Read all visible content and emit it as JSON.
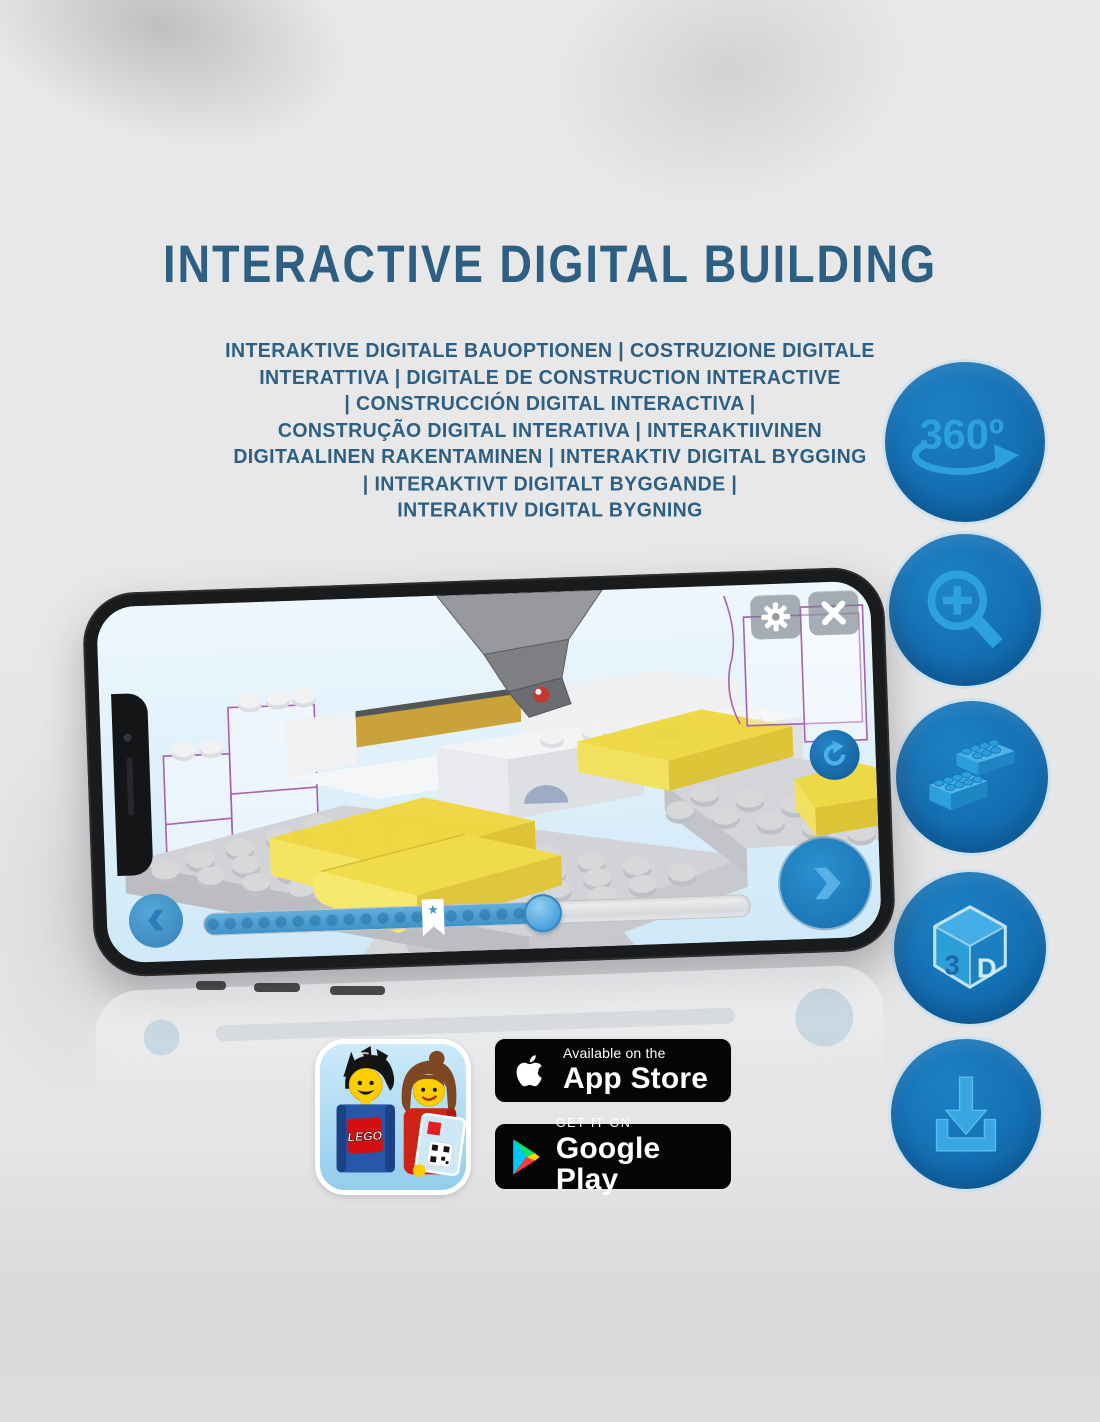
{
  "header": {
    "title": "INTERACTIVE DIGITAL BUILDING"
  },
  "subtitle": {
    "lines": [
      "INTERAKTIVE DIGITALE BAUOPTIONEN | COSTRUZIONE DIGITALE",
      "INTERATTIVA | DIGITALE DE CONSTRUCTION INTERACTIVE",
      "| CONSTRUCCIÓN DIGITAL INTERACTIVA |",
      "CONSTRUÇÃO DIGITAL INTERATIVA | INTERAKTIIVINEN",
      "DIGITAALINEN RAKENTAMINEN | INTERAKTIV DIGITAL BYGGING",
      "| INTERAKTIVT DIGITALT BYGGANDE |",
      "INTERAKTIV DIGITAL BYGNING"
    ]
  },
  "features": [
    {
      "name": "360-rotation",
      "label": "360º"
    },
    {
      "name": "zoom-in-magnifier",
      "label": ""
    },
    {
      "name": "lego-bricks",
      "label": ""
    },
    {
      "name": "3d-view-cube",
      "letter_left": "3",
      "letter_right": "D"
    },
    {
      "name": "download",
      "label": ""
    }
  ],
  "phone": {
    "app": "LEGO building instructions viewer",
    "ui": {
      "buttons": [
        "settings-gear",
        "close",
        "rotate-view",
        "previous-step",
        "next-step"
      ],
      "progress": {
        "fill_percent": 62,
        "bookmark_percent": 42,
        "star_glyph": "★"
      }
    }
  },
  "badges": {
    "lego_app": {
      "logo_text": "LEGO"
    },
    "app_store": {
      "line1": "Available on the",
      "line2": "App Store"
    },
    "google_play": {
      "line1": "GET IT ON",
      "line2": "Google Play"
    }
  },
  "colors": {
    "title_blue": "#2d5f83",
    "circle_blue": "#1470b4",
    "icon_blue": "#2da1e0",
    "brick_yellow": "#f2dd45",
    "ghost_outline_purple": "#a761ae",
    "badge_black": "#050505"
  }
}
